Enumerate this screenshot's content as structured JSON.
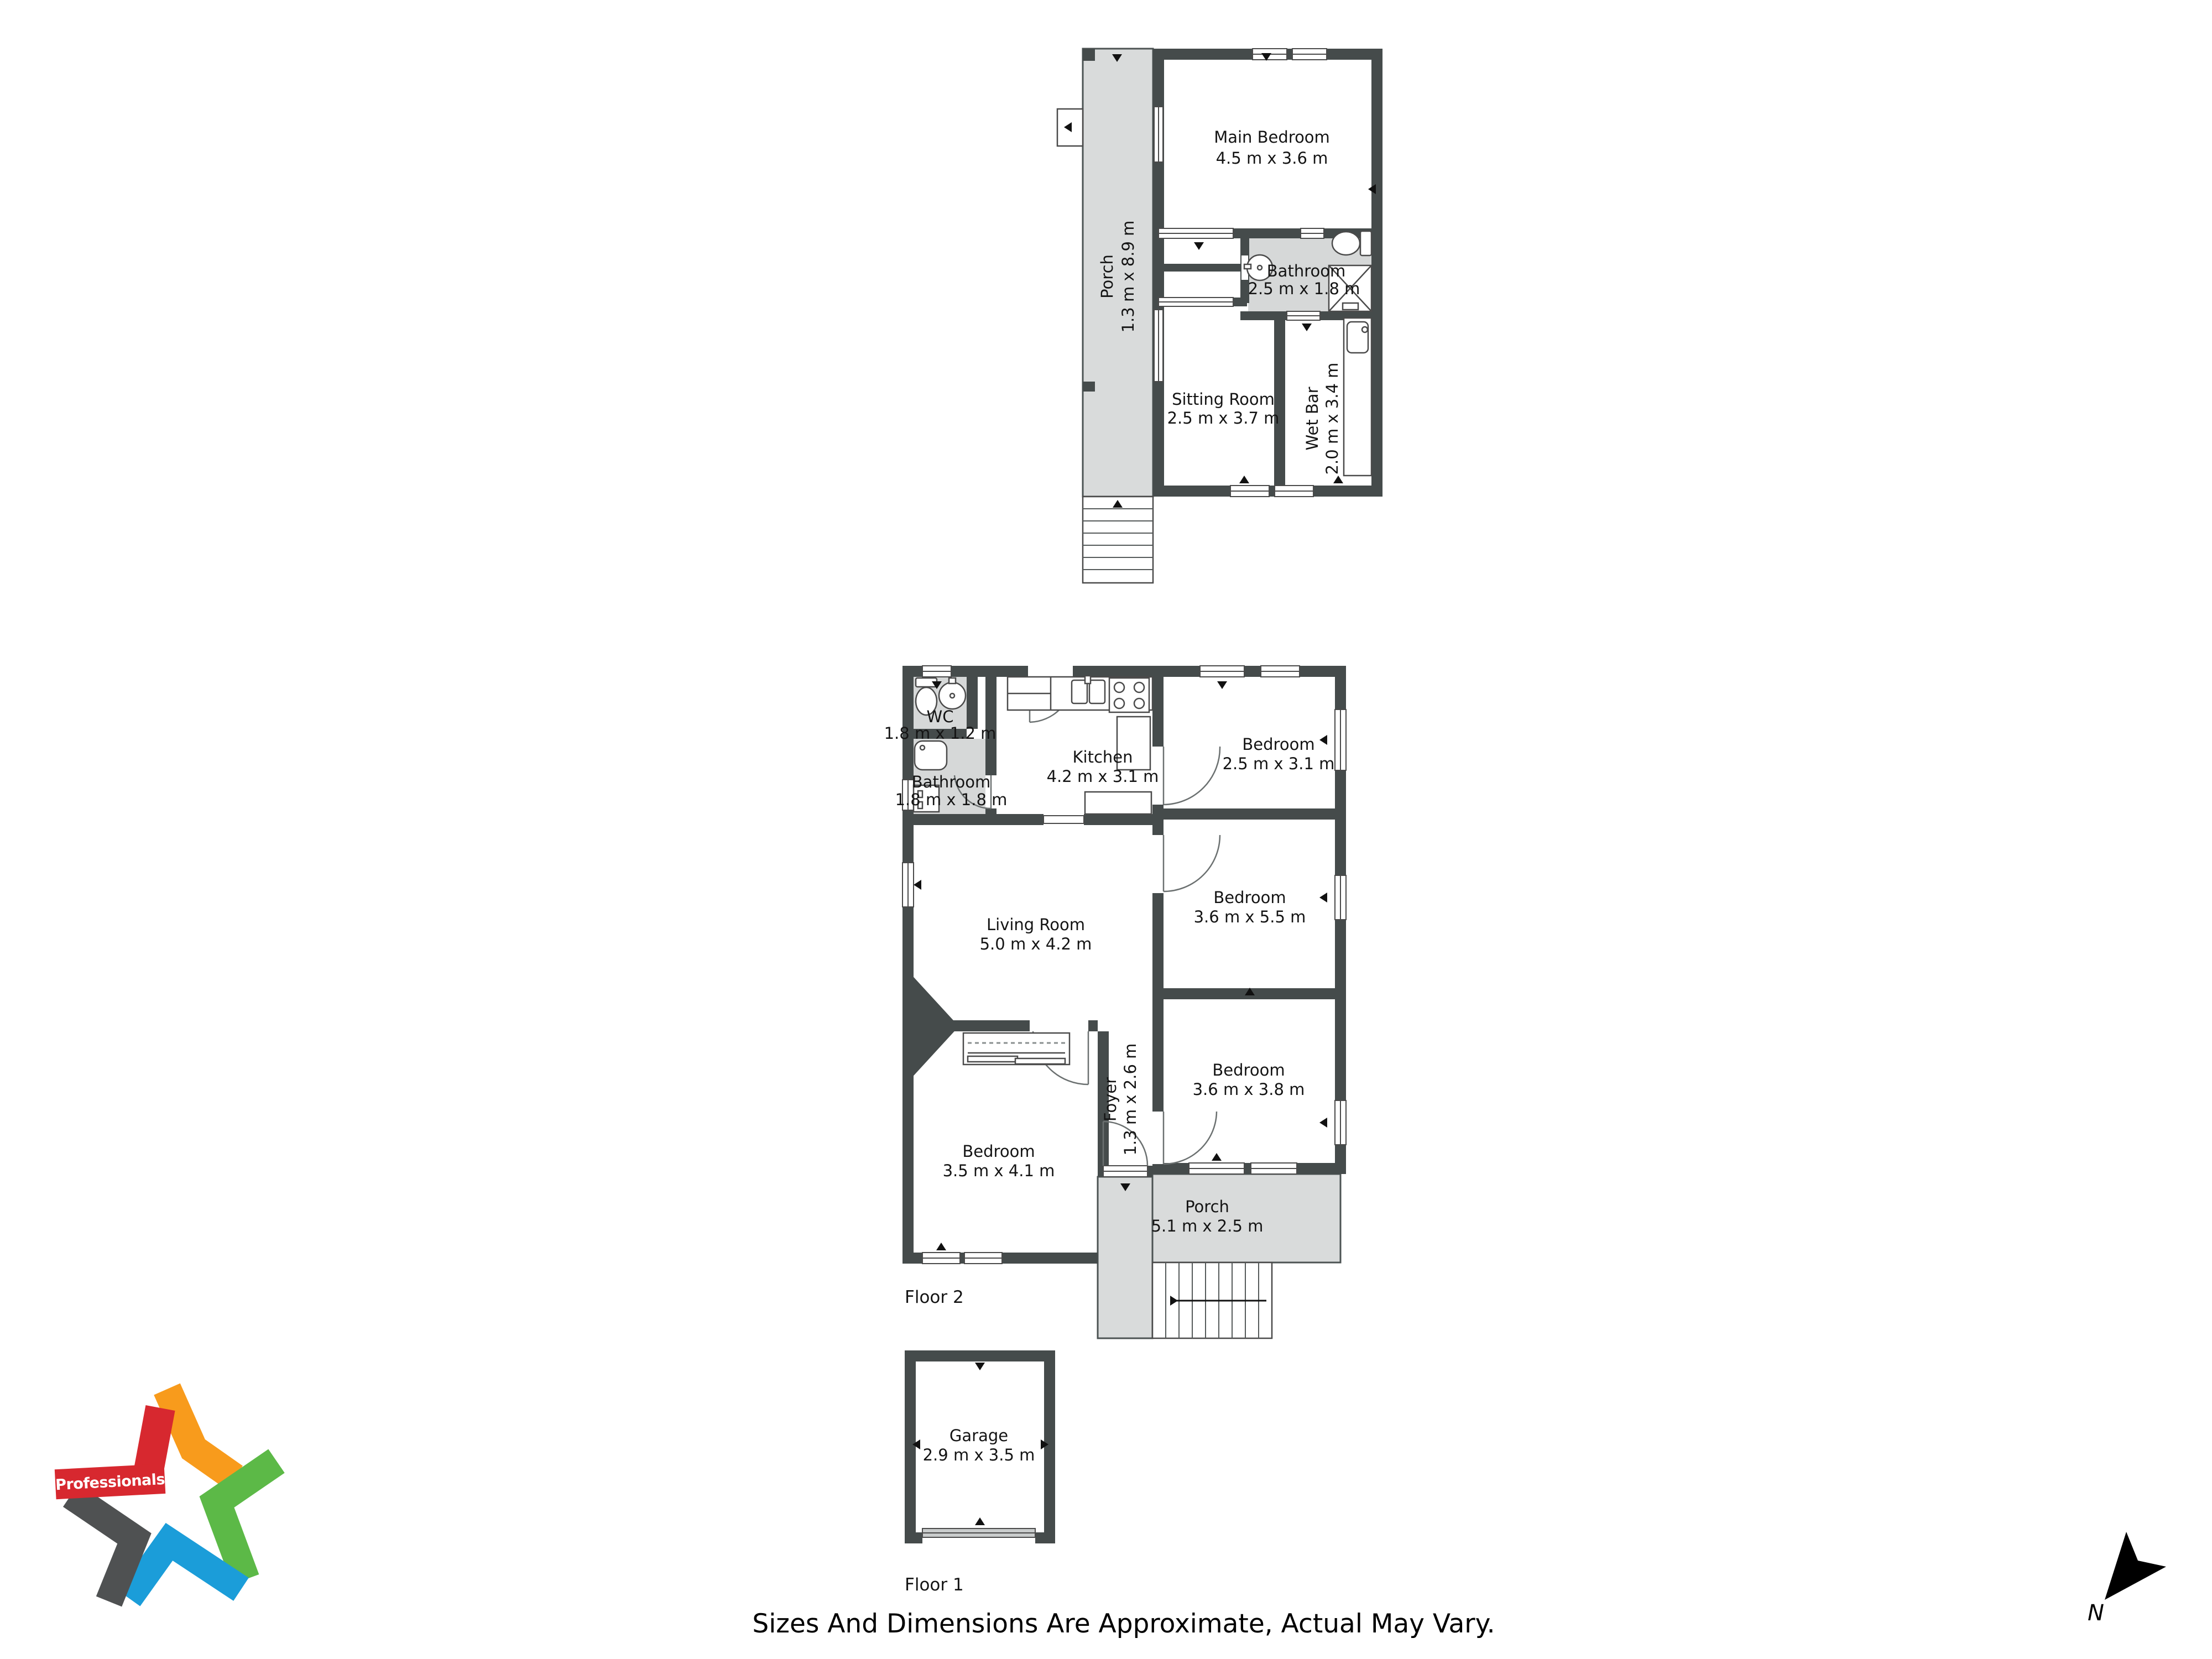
{
  "branding": {
    "name": "Professionals"
  },
  "compass": {
    "label": "N"
  },
  "footer": {
    "disclaimer": "Sizes And Dimensions Are Approximate, Actual May Vary."
  },
  "palette": {
    "wall": "#454b4b",
    "porch_floor": "#d9dbdb",
    "bath_floor": "#d6d8d8",
    "brand_red": "#d7282f",
    "brand_orange": "#f89b1c",
    "brand_green": "#5cb947",
    "brand_blue": "#1b9dd9",
    "brand_gray": "#4f5152"
  },
  "plans": {
    "upper": {
      "rooms": [
        {
          "name": "Main Bedroom",
          "dims": "4.5 m x 3.6 m"
        },
        {
          "name": "Porch",
          "dims": "1.3 m x 8.9 m"
        },
        {
          "name": "Bathroom",
          "dims": "2.5 m x 1.8 m"
        },
        {
          "name": "Sitting Room",
          "dims": "2.5 m x 3.7 m"
        },
        {
          "name": "Wet Bar",
          "dims": "2.0 m x 3.4 m"
        }
      ]
    },
    "floor2": {
      "label": "Floor 2",
      "rooms": [
        {
          "name": "WC",
          "dims": "1.8 m x 1.2 m"
        },
        {
          "name": "Kitchen",
          "dims": "4.2 m x 3.1 m"
        },
        {
          "name": "Bedroom",
          "dims": "2.5 m x 3.1 m"
        },
        {
          "name": "Bathroom",
          "dims": "1.8 m x 1.8 m"
        },
        {
          "name": "Living Room",
          "dims": "5.0 m x 4.2 m"
        },
        {
          "name": "Bedroom",
          "dims": "3.6 m x 5.5 m"
        },
        {
          "name": "Bedroom",
          "dims": "3.6 m x 3.8 m"
        },
        {
          "name": "Foyer",
          "dims": "1.3 m x 2.6 m"
        },
        {
          "name": "Bedroom",
          "dims": "3.5 m x 4.1 m"
        },
        {
          "name": "Porch",
          "dims": "5.1 m x 2.5 m"
        }
      ]
    },
    "floor1": {
      "label": "Floor 1",
      "rooms": [
        {
          "name": "Garage",
          "dims": "2.9 m x 3.5 m"
        }
      ]
    }
  }
}
